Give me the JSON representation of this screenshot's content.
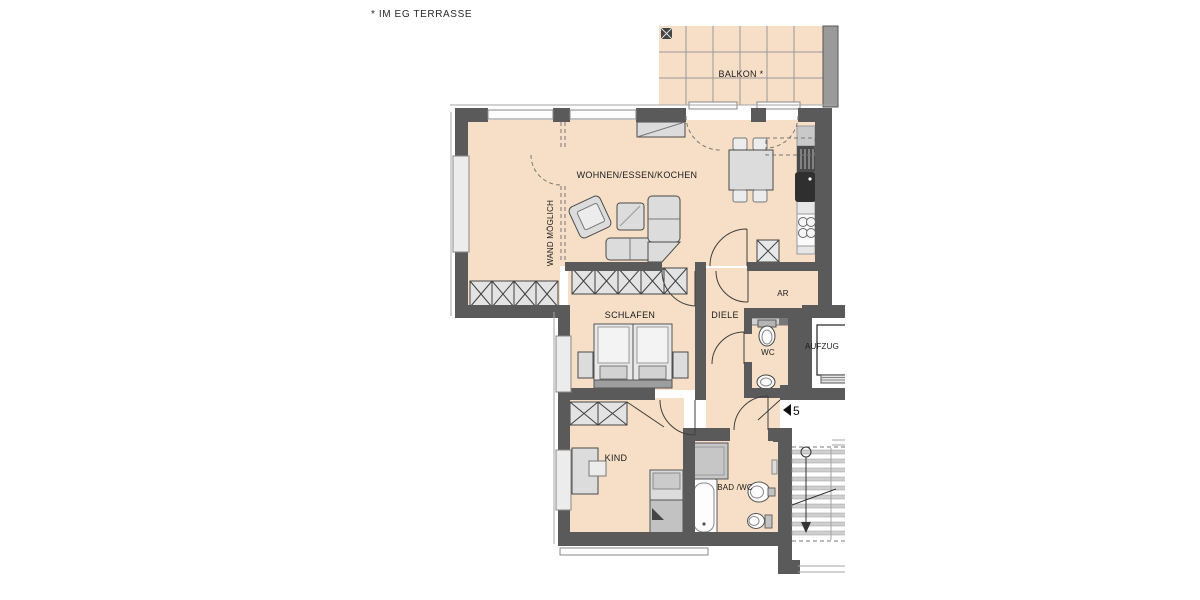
{
  "title_note": "* IM EG TERRASSE",
  "rooms": {
    "balkon": {
      "label": "BALKON *"
    },
    "wohnen": {
      "label": "WOHNEN/ESSEN/KOCHEN"
    },
    "schlafen": {
      "label": "SCHLAFEN"
    },
    "diele": {
      "label": "DIELE"
    },
    "ar": {
      "label": "AR"
    },
    "wc": {
      "label": "WC"
    },
    "kind": {
      "label": "KIND"
    },
    "bad": {
      "label": "BAD /WC"
    },
    "aufzug": {
      "label": "AUFZUG"
    }
  },
  "annotations": {
    "wand_moeglich": "WAND MÖGLICH",
    "apartment_number": "5"
  },
  "colors": {
    "floor": "#f6dfc6",
    "wall": "#5a5a5a",
    "furniture": "#dcdcdc",
    "outline": "#3f3f3f",
    "text": "#1c1c1c"
  }
}
